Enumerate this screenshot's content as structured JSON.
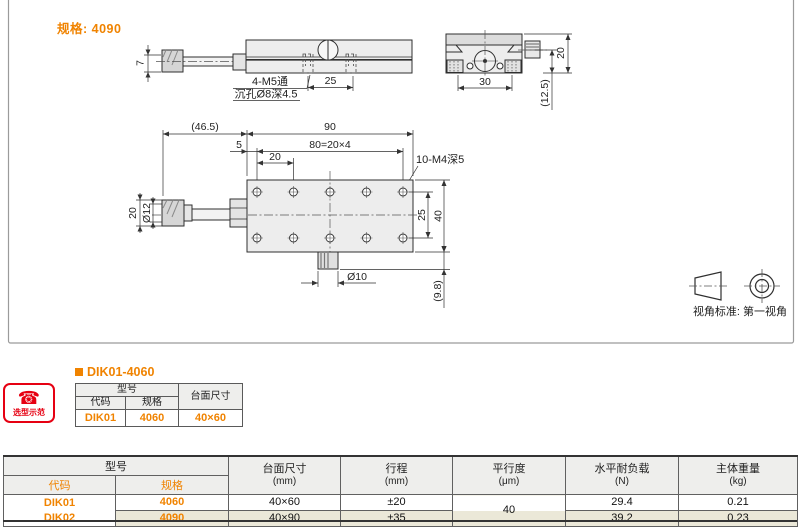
{
  "page": {
    "spec_note": "规格: 4090"
  },
  "drawing": {
    "dims": {
      "side_height": "7",
      "side_hole_line1": "4-M5通",
      "side_hole_line2": "沉孔Ø8深4.5",
      "side_25": "25",
      "end_30": "30",
      "end_20": "20",
      "end_125": "(12.5)",
      "plan_465": "(46.5)",
      "plan_90": "90",
      "plan_5": "5",
      "plan_80": "80=20×4",
      "plan_20": "20",
      "plan_tap": "10-M4深5",
      "knob_20": "20",
      "knob_d12": "Ø12",
      "plan_25": "25",
      "plan_40": "40",
      "plan_d10": "Ø10",
      "plan_98": "(9.8)"
    },
    "view_note": "视角标准: 第一视角"
  },
  "selection_example": {
    "icon_label": "选型示范",
    "phone_icon": "☎",
    "title": "DIK01-4060",
    "table": {
      "model_header": "型号",
      "code_header": "代码",
      "spec_header": "规格",
      "size_header": "台面尺寸",
      "code": "DIK01",
      "spec": "4060",
      "size": "40×60"
    }
  },
  "spec_table": {
    "headers": {
      "model": "型号",
      "code": "代码",
      "spec": "规格",
      "size": "台面尺寸",
      "size_unit": "(mm)",
      "travel": "行程",
      "travel_unit": "(mm)",
      "parallelism": "平行度",
      "parallelism_unit": "(μm)",
      "load": "水平耐负载",
      "load_unit": "(N)",
      "weight": "主体重量",
      "weight_unit": "(kg)"
    },
    "rows": [
      {
        "code": "DIK01",
        "spec": "4060",
        "size": "40×60",
        "travel": "±20",
        "load": "29.4",
        "weight": "0.21"
      },
      {
        "code": "DIK02",
        "spec": "4090",
        "size": "40×90",
        "travel": "±35",
        "load": "39.2",
        "weight": "0.23"
      }
    ],
    "parallelism_value": "40"
  },
  "colors": {
    "accent": "#f08300",
    "row_alt": "#ebe8d8",
    "header_bg": "#eeeeec",
    "icon_red": "#e60012"
  }
}
